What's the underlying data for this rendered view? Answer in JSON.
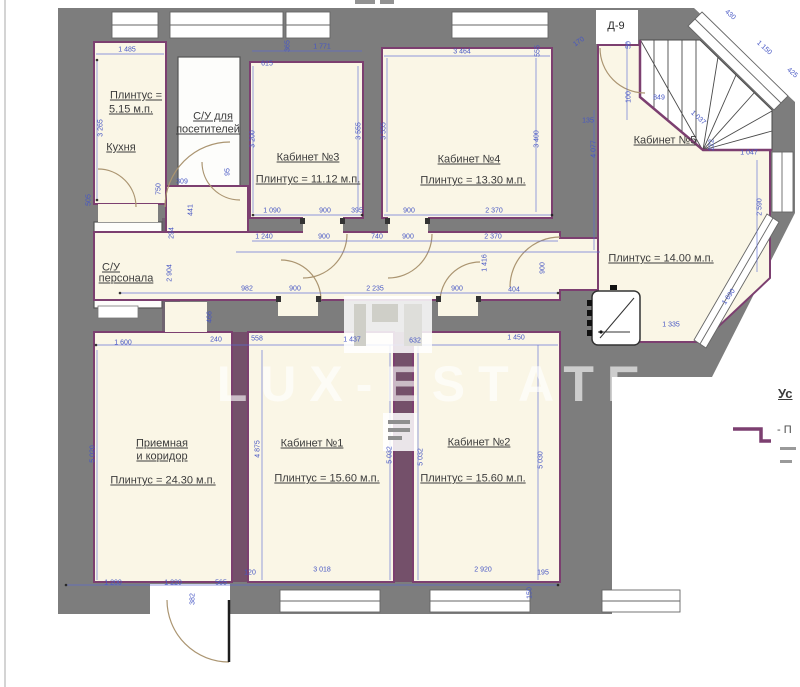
{
  "door_mark": {
    "text": "Д-9",
    "x": 616,
    "y": 26
  },
  "legend": {
    "heading": "Ус",
    "item": "- П"
  },
  "watermark": {
    "text": "LUX-ESTATE"
  },
  "colors": {
    "wall_gray": "#7d7d7d",
    "accent_purple": "#7c3f70",
    "room_cream": "#faf6e6",
    "wet_room_white": "#fdfdfb",
    "dimension_blue": "#4656c4",
    "label_gray": "#3c3c3c"
  },
  "room_labels": [
    {
      "text": "Плинтус =",
      "x": 136,
      "y": 96
    },
    {
      "text": "5.15 м.п.",
      "x": 131,
      "y": 110
    },
    {
      "text": "Кухня",
      "x": 121,
      "y": 148
    },
    {
      "text": "С/У для",
      "x": 213,
      "y": 117
    },
    {
      "text": "посетителей",
      "x": 208,
      "y": 130
    },
    {
      "text": "С/У",
      "x": 111,
      "y": 268
    },
    {
      "text": "персонала",
      "x": 126,
      "y": 279
    },
    {
      "text": "Кабинет №3",
      "x": 308,
      "y": 158
    },
    {
      "text": "Плинтус = 11.12 м.п.",
      "x": 308,
      "y": 180
    },
    {
      "text": "Кабинет №4",
      "x": 469,
      "y": 160
    },
    {
      "text": "Плинтус = 13.30 м.п.",
      "x": 473,
      "y": 181
    },
    {
      "text": "Кабинет №5",
      "x": 665,
      "y": 141
    },
    {
      "text": "Плинтус = 14.00 м.п.",
      "x": 661,
      "y": 259
    },
    {
      "text": "Приемная",
      "x": 162,
      "y": 444
    },
    {
      "text": "и коридор",
      "x": 162,
      "y": 457
    },
    {
      "text": "Плинтус = 24.30 м.п.",
      "x": 163,
      "y": 481
    },
    {
      "text": "Кабинет №1",
      "x": 312,
      "y": 444
    },
    {
      "text": "Плинтус = 15.60 м.п.",
      "x": 327,
      "y": 479
    },
    {
      "text": "Кабинет №2",
      "x": 479,
      "y": 443
    },
    {
      "text": "Плинтус = 15.60 м.п.",
      "x": 473,
      "y": 479
    }
  ],
  "dimensions": [
    {
      "t": "1 485",
      "x": 127,
      "y": 50,
      "r": 0
    },
    {
      "t": "3 265",
      "x": 101,
      "y": 128,
      "r": -90
    },
    {
      "t": "505",
      "x": 89,
      "y": 200,
      "r": -90
    },
    {
      "t": "95",
      "x": 228,
      "y": 172,
      "r": -90
    },
    {
      "t": "750",
      "x": 159,
      "y": 189,
      "r": -90
    },
    {
      "t": "309",
      "x": 182,
      "y": 182,
      "r": 0
    },
    {
      "t": "441",
      "x": 191,
      "y": 210,
      "r": -90
    },
    {
      "t": "615",
      "x": 267,
      "y": 64,
      "r": 0
    },
    {
      "t": "365",
      "x": 288,
      "y": 46,
      "r": -90
    },
    {
      "t": "1 771",
      "x": 322,
      "y": 47,
      "r": 0
    },
    {
      "t": "3 200",
      "x": 253,
      "y": 139,
      "r": -90
    },
    {
      "t": "3 555",
      "x": 359,
      "y": 131,
      "r": -90
    },
    {
      "t": "3 555",
      "x": 384,
      "y": 131,
      "r": -90
    },
    {
      "t": "3 464",
      "x": 462,
      "y": 52,
      "r": 0
    },
    {
      "t": "555",
      "x": 538,
      "y": 51,
      "r": -90
    },
    {
      "t": "3 400",
      "x": 537,
      "y": 139,
      "r": -90
    },
    {
      "t": "170",
      "x": 579,
      "y": 42,
      "r": -35
    },
    {
      "t": "50",
      "x": 629,
      "y": 45,
      "r": -90
    },
    {
      "t": "430",
      "x": 730,
      "y": 15,
      "r": 42
    },
    {
      "t": "1 150",
      "x": 764,
      "y": 48,
      "r": 42
    },
    {
      "t": "425",
      "x": 792,
      "y": 73,
      "r": 42
    },
    {
      "t": "100",
      "x": 629,
      "y": 97,
      "r": -90
    },
    {
      "t": "849",
      "x": 659,
      "y": 98,
      "r": 0
    },
    {
      "t": "1 037",
      "x": 698,
      "y": 118,
      "r": 42
    },
    {
      "t": "222",
      "x": 712,
      "y": 145,
      "r": -90
    },
    {
      "t": "1 047",
      "x": 749,
      "y": 153,
      "r": 0
    },
    {
      "t": "135",
      "x": 588,
      "y": 121,
      "r": 0
    },
    {
      "t": "4 077",
      "x": 594,
      "y": 149,
      "r": -90
    },
    {
      "t": "2 590",
      "x": 760,
      "y": 207,
      "r": -90
    },
    {
      "t": "1 690",
      "x": 729,
      "y": 297,
      "r": -55
    },
    {
      "t": "1 335",
      "x": 671,
      "y": 325,
      "r": 0
    },
    {
      "t": "1 090",
      "x": 272,
      "y": 211,
      "r": 0
    },
    {
      "t": "900",
      "x": 325,
      "y": 211,
      "r": 0
    },
    {
      "t": "395",
      "x": 357,
      "y": 211,
      "r": 0
    },
    {
      "t": "900",
      "x": 409,
      "y": 211,
      "r": 0
    },
    {
      "t": "2 370",
      "x": 494,
      "y": 211,
      "r": 0
    },
    {
      "t": "1 240",
      "x": 264,
      "y": 237,
      "r": 0
    },
    {
      "t": "900",
      "x": 324,
      "y": 237,
      "r": 0
    },
    {
      "t": "740",
      "x": 377,
      "y": 237,
      "r": 0
    },
    {
      "t": "900",
      "x": 408,
      "y": 237,
      "r": 0
    },
    {
      "t": "2 370",
      "x": 493,
      "y": 237,
      "r": 0
    },
    {
      "t": "982",
      "x": 247,
      "y": 289,
      "r": 0
    },
    {
      "t": "900",
      "x": 295,
      "y": 289,
      "r": 0
    },
    {
      "t": "2 235",
      "x": 375,
      "y": 289,
      "r": 0
    },
    {
      "t": "900",
      "x": 457,
      "y": 289,
      "r": 0
    },
    {
      "t": "404",
      "x": 514,
      "y": 290,
      "r": 0
    },
    {
      "t": "1 416",
      "x": 485,
      "y": 263,
      "r": -90
    },
    {
      "t": "900",
      "x": 543,
      "y": 268,
      "r": -90
    },
    {
      "t": "466",
      "x": 210,
      "y": 317,
      "r": -90
    },
    {
      "t": "2 904",
      "x": 170,
      "y": 273,
      "r": -90
    },
    {
      "t": "294",
      "x": 172,
      "y": 233,
      "r": -90
    },
    {
      "t": "240",
      "x": 216,
      "y": 340,
      "r": 0
    },
    {
      "t": "558",
      "x": 257,
      "y": 339,
      "r": 0
    },
    {
      "t": "1 437",
      "x": 352,
      "y": 340,
      "r": 0
    },
    {
      "t": "632",
      "x": 415,
      "y": 341,
      "r": 0
    },
    {
      "t": "1 450",
      "x": 516,
      "y": 338,
      "r": 0
    },
    {
      "t": "1 600",
      "x": 123,
      "y": 343,
      "r": 0
    },
    {
      "t": "5 020",
      "x": 93,
      "y": 454,
      "r": -90
    },
    {
      "t": "4 875",
      "x": 258,
      "y": 449,
      "r": -90
    },
    {
      "t": "5 032",
      "x": 390,
      "y": 455,
      "r": -90
    },
    {
      "t": "5 032",
      "x": 421,
      "y": 457,
      "r": -90
    },
    {
      "t": "5 030",
      "x": 541,
      "y": 460,
      "r": -90
    },
    {
      "t": "1 200",
      "x": 113,
      "y": 583,
      "r": 0
    },
    {
      "t": "1 220",
      "x": 173,
      "y": 583,
      "r": 0
    },
    {
      "t": "565",
      "x": 221,
      "y": 583,
      "r": 0
    },
    {
      "t": "382",
      "x": 193,
      "y": 599,
      "r": -90
    },
    {
      "t": "120",
      "x": 250,
      "y": 573,
      "r": 0
    },
    {
      "t": "3 018",
      "x": 322,
      "y": 570,
      "r": 0
    },
    {
      "t": "2 920",
      "x": 483,
      "y": 570,
      "r": 0
    },
    {
      "t": "195",
      "x": 543,
      "y": 573,
      "r": 0
    },
    {
      "t": "150",
      "x": 530,
      "y": 593,
      "r": -90
    }
  ]
}
